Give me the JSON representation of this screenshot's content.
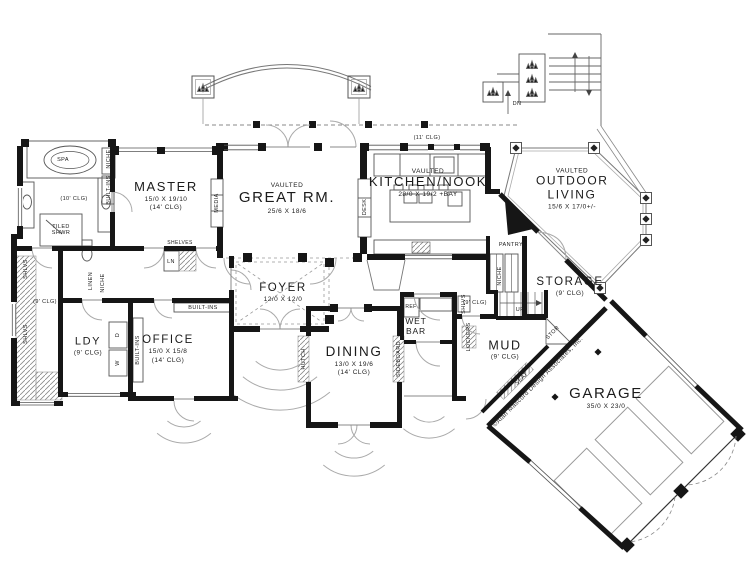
{
  "plan": {
    "copyright": "©Alan Mascord Design Associates, Inc."
  },
  "rooms": {
    "master": {
      "name": "MASTER",
      "dims": "15/0 X 19/10",
      "clg": "(14' CLG)"
    },
    "great": {
      "prefix": "VAULTED",
      "name": "GREAT RM.",
      "dims": "25/6 X 18/6"
    },
    "kitchen": {
      "prefix": "VAULTED",
      "name": "KITCHEN/NOOK",
      "dims": "28/0 X 19/2 +BAY"
    },
    "outdoor": {
      "prefix": "VAULTED",
      "name": "OUTDOOR LIVING",
      "dims": "15/6 X 17/0+/-"
    },
    "storage": {
      "name": "STORAGE",
      "clg": "(9' CLG)"
    },
    "garage": {
      "name": "GARAGE",
      "dims": "35/0 X 23/0"
    },
    "mud": {
      "name": "MUD",
      "clg": "(9' CLG)"
    },
    "wetbar": {
      "name": "WET BAR"
    },
    "dining": {
      "name": "DINING",
      "dims": "13/0 X 19/6",
      "clg": "(14' CLG)"
    },
    "foyer": {
      "name": "FOYER",
      "dims": "12/0 X 12/0"
    },
    "office": {
      "name": "OFFICE",
      "dims": "15/0 X 15/8",
      "clg": "(14' CLG)"
    },
    "ldy": {
      "name": "LDY",
      "clg": "(9' CLG)"
    }
  },
  "fixtures": {
    "spa": "SPA",
    "tiled_shwr": "TILED SHWR",
    "clg10": "(10' CLG)",
    "clg9": "(9' CLG)",
    "clg11": "(11' CLG)",
    "niche": "NICHE",
    "built_ins": "BUILT-INS",
    "shlvs": "SHLVS",
    "linen": "LINEN",
    "dryer": "D",
    "washer": "W",
    "shelves": "SHELVES",
    "linen_sm": "LN",
    "media": "MEDIA",
    "desk": "DESK",
    "pantry": "PANTRY",
    "ref": "REF",
    "hutch": "HUTCH",
    "sideboard": "SIDEBOARD",
    "seat": "SEAT",
    "lockers": "LOCKERS",
    "up": "UP",
    "dn": "DN",
    "stor": "STOR"
  }
}
